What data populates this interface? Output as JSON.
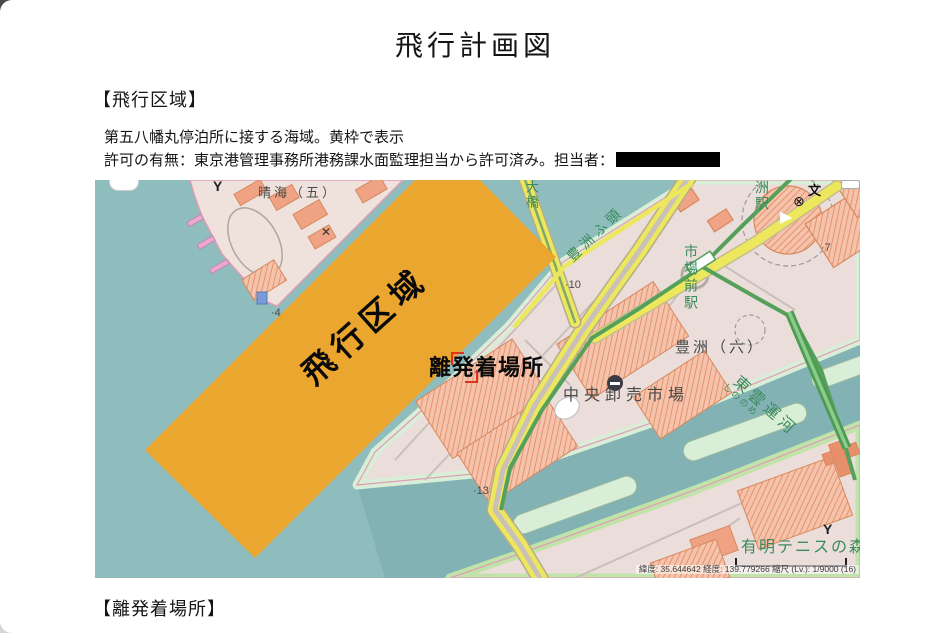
{
  "document": {
    "title": "飛行計画図",
    "section_flight_area": "【飛行区域】",
    "body_line1": "第五八幡丸停泊所に接する海域。黄枠で表示",
    "body_line2": "許可の有無：東京港管理事務所港務課水面監理担当から許可済み。担当者：",
    "section_landing": "【離発着場所】"
  },
  "map": {
    "overlay_flight_area": "飛行区域",
    "overlay_landing_site": "離発着場所",
    "labels": {
      "harumi5": "晴海（五）",
      "harumi_ohashi_partial": "大橋",
      "toyosu_wharf": "豊洲ふ頭",
      "shin_toyosu_station_partial": "洲駅",
      "shijomae_station": "市場前駅",
      "toyosu6": "豊洲（六）",
      "central_wholesale_market": "中央卸売市場",
      "shinonome_canal": "東雲運河",
      "shinonome_canal_kana": "しののめ",
      "ariake_tennis_no_mori": "有明テニスの森"
    },
    "elevation_points": {
      "p13": "·13",
      "p10": "·10",
      "p7": "·7",
      "p4": "·4"
    },
    "symbols": {
      "school": "文",
      "circled_cross": "⊗",
      "play": "▶",
      "port_left": "Y",
      "port_right": "Y",
      "cross_mark": "✕"
    },
    "attribution": "緯度: 35.644642 経度: 139.779266 縮尺 (Lv.): 1/9000 (16)",
    "colors": {
      "water": "#8FBCBC",
      "canal": "#7FAFB3",
      "land": "#EBDEDA",
      "coast_green": "#D8EED6",
      "flight_area_orange": "#EBA62F",
      "road_yellow": "#EDE75E",
      "rail_green": "#55A15C",
      "building_salmon": "#E8906C",
      "label_green": "#3A8A5D"
    }
  }
}
